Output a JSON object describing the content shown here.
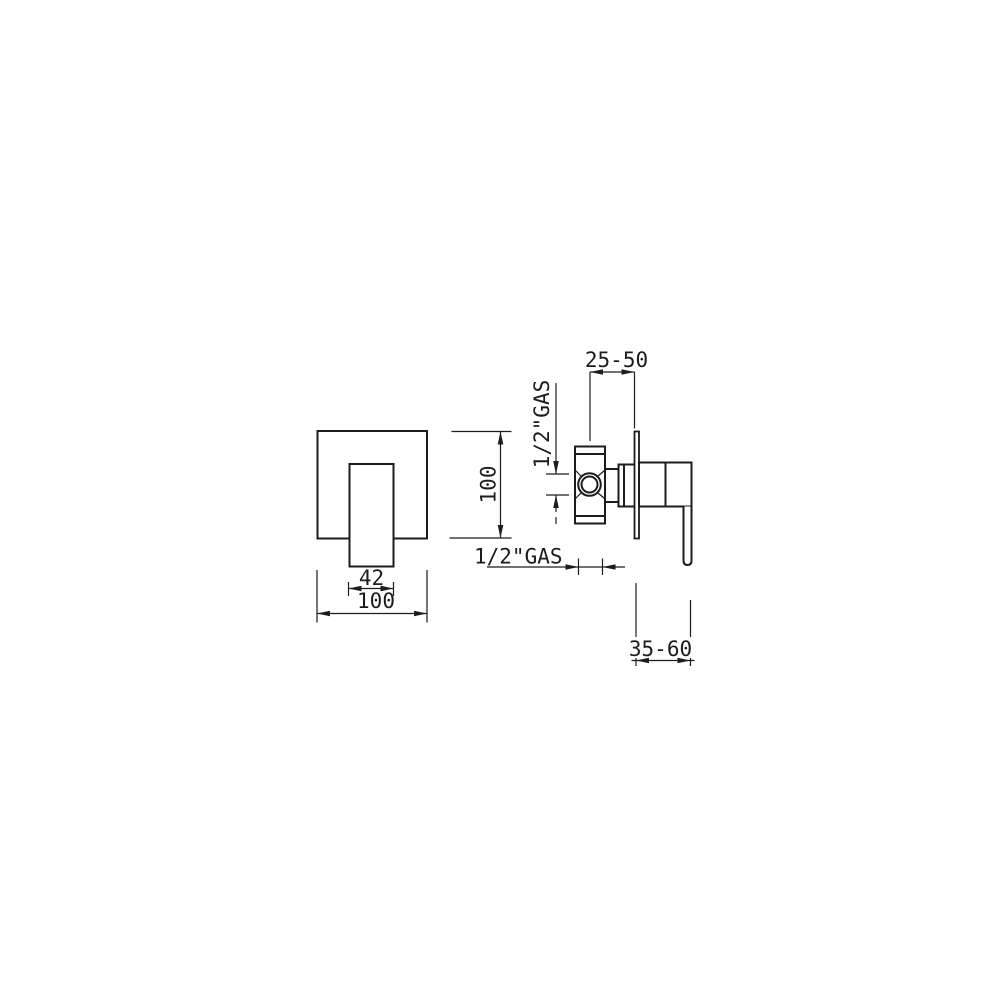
{
  "page": {
    "background": "#ffffff",
    "line_color": "#1c1c1c"
  },
  "views": {
    "front": {
      "dims": {
        "handle_width": "42",
        "plate_width": "100",
        "plate_height": "100"
      }
    },
    "side": {
      "dims": {
        "mounting_depth": "25-50",
        "inlet_thread": "1/2\"GAS",
        "outlet_thread": "1/2\"GAS",
        "handle_projection": "35-60"
      }
    }
  }
}
